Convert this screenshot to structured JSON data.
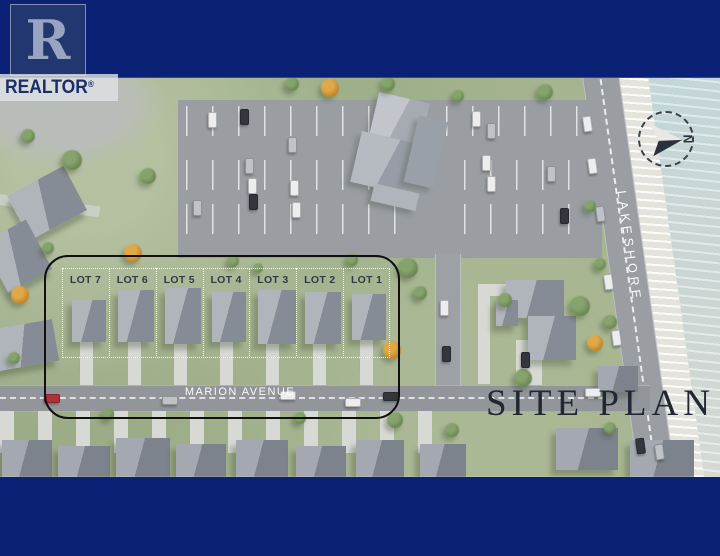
{
  "branding": {
    "logo_letter": "R",
    "logo_label": "REALTOR",
    "registered_mark": "®"
  },
  "plan": {
    "title": "SITE PLAN",
    "compass_label": "N",
    "street_marion": "MARION AVENUE",
    "street_lakeshore": "LAKESHORE",
    "lots": [
      {
        "label": "LOT 7"
      },
      {
        "label": "LOT 6"
      },
      {
        "label": "LOT 5"
      },
      {
        "label": "LOT 4"
      },
      {
        "label": "LOT 3"
      },
      {
        "label": "LOT 2"
      },
      {
        "label": "LOT 1"
      }
    ]
  },
  "colors": {
    "frame_navy": "#0a2176",
    "outline_black": "#101010",
    "grass_green": "#a6b48f",
    "road_gray": "#95999e",
    "water_blue": "#c3d6d9",
    "title_text": "#222831",
    "lot_label_text": "#303a47"
  }
}
